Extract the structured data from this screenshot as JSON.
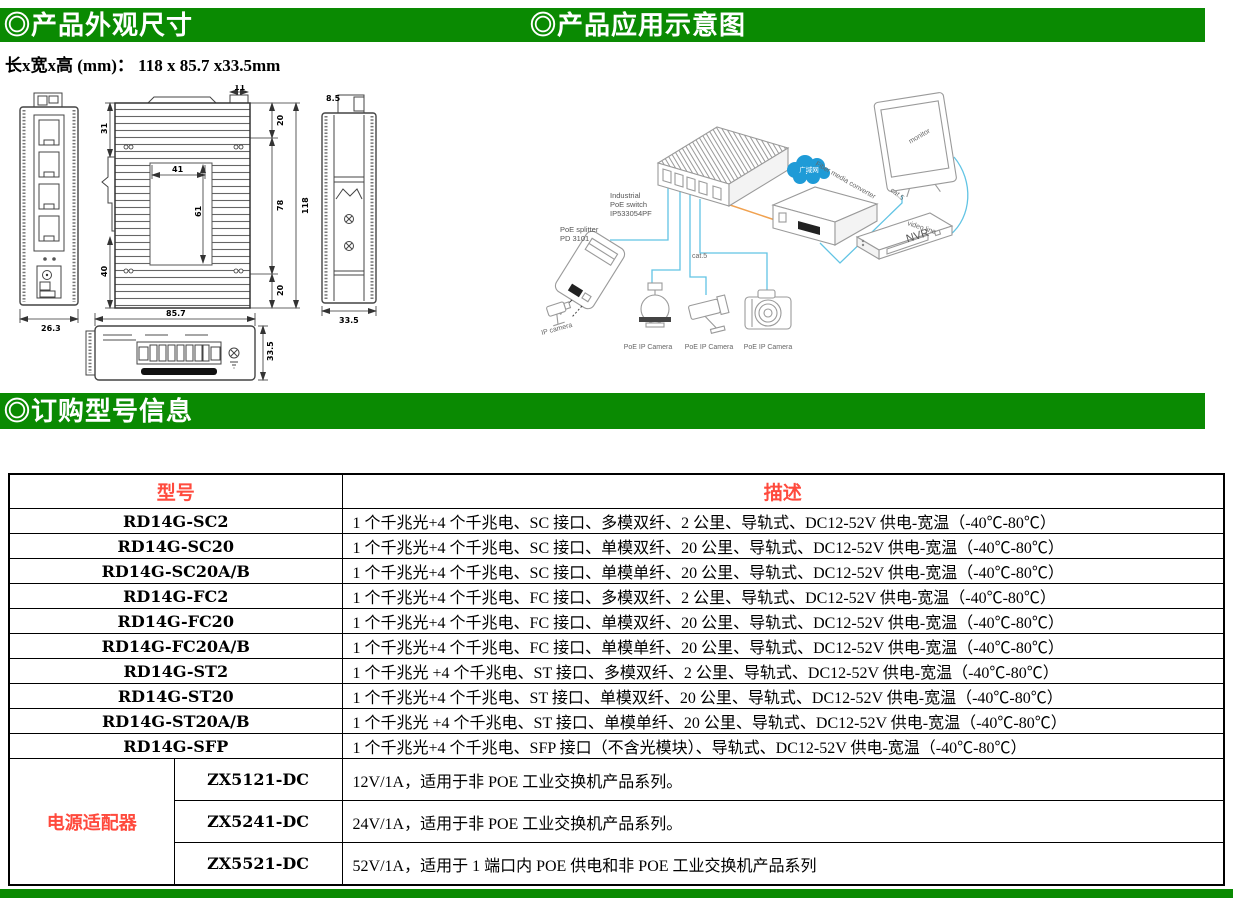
{
  "headers": {
    "dimensions_title": "◎产品外观尺寸",
    "application_title": "◎产品应用示意图",
    "ordering_title": "◎订购型号信息"
  },
  "size_label": "长x宽x高 (mm)： 118 x 85.7 x33.5mm",
  "colors": {
    "header_green": "#0a8a02",
    "table_header_red": "#ff4a3d",
    "cable_cyan": "#62c4e4",
    "cable_orange": "#f0a14f",
    "cloud_blue": "#1f9bd7"
  },
  "dims": {
    "front_width": "26.3",
    "main_top_tab": "11",
    "main_left_top": "31",
    "main_left_bottom": "40",
    "main_inner_width": "41",
    "main_inner_height": "61",
    "main_right_top": "20",
    "main_right_mid": "78",
    "main_right_bottom": "20",
    "main_total_height": "118",
    "bottom_width": "85.7",
    "bottom_height": "33.5",
    "side_top": "8.5",
    "side_bottom": "33.5"
  },
  "app": {
    "switch_label_1": "Industrial",
    "switch_label_2": "PoE switch",
    "switch_label_3": "IP533054PF",
    "splitter_label_1": "PoE splitter",
    "splitter_label_2": "PD 3101",
    "cloud_label": "广域网",
    "converter_label": "Fiber media converter",
    "monitor_label": "monitor",
    "nvr_label": "NVR",
    "cat5_center": "cat.5",
    "cat5_right": "cat.5",
    "video_line_label": "video line",
    "ip_camera_label": "IP camera",
    "poe_cam1": "PoE IP Camera",
    "poe_cam2": "PoE IP Camera",
    "poe_cam3": "PoE IP Camera"
  },
  "table": {
    "col_model": "型号",
    "col_desc": "描述",
    "rows": [
      {
        "model": "RD14G-SC2",
        "desc": "1 个千兆光+4 个千兆电、SC 接口、多模双纤、2 公里、导轨式、DC12-52V 供电-宽温（-40℃-80℃）"
      },
      {
        "model": "RD14G-SC20",
        "desc": "1 个千兆光+4 个千兆电、SC 接口、单模双纤、20 公里、导轨式、DC12-52V 供电-宽温（-40℃-80℃）"
      },
      {
        "model": "RD14G-SC20A/B",
        "desc": "1 个千兆光+4 个千兆电、SC 接口、单模单纤、20 公里、导轨式、DC12-52V 供电-宽温（-40℃-80℃）"
      },
      {
        "model": "RD14G-FC2",
        "desc": "1 个千兆光+4 个千兆电、FC 接口、多模双纤、2 公里、导轨式、DC12-52V 供电-宽温（-40℃-80℃）"
      },
      {
        "model": "RD14G-FC20",
        "desc": "1 个千兆光+4 个千兆电、FC 接口、单模双纤、20 公里、导轨式、DC12-52V 供电-宽温（-40℃-80℃）"
      },
      {
        "model": "RD14G-FC20A/B",
        "desc": "1 个千兆光+4 个千兆电、FC 接口、单模单纤、20 公里、导轨式、DC12-52V 供电-宽温（-40℃-80℃）"
      },
      {
        "model": "RD14G-ST2",
        "desc": "1 个千兆光 +4 个千兆电、ST 接口、多模双纤、2 公里、导轨式、DC12-52V 供电-宽温（-40℃-80℃）"
      },
      {
        "model": "RD14G-ST20",
        "desc": "1 个千兆光+4 个千兆电、ST 接口、单模双纤、20 公里、导轨式、DC12-52V 供电-宽温（-40℃-80℃）"
      },
      {
        "model": "RD14G-ST20A/B",
        "desc": "1 个千兆光 +4 个千兆电、ST 接口、单模单纤、20 公里、导轨式、DC12-52V 供电-宽温（-40℃-80℃）"
      },
      {
        "model": "RD14G-SFP",
        "desc": "1 个千兆光+4 个千兆电、SFP 接口（不含光模块）、导轨式、DC12-52V 供电-宽温（-40℃-80℃）"
      }
    ],
    "power_group": {
      "label": "电源适配器",
      "rows": [
        {
          "model": "ZX5121-DC",
          "desc": "12V/1A，适用于非 POE 工业交换机产品系列。"
        },
        {
          "model": "ZX5241-DC",
          "desc": "24V/1A，适用于非 POE 工业交换机产品系列。"
        },
        {
          "model": "ZX5521-DC",
          "desc": "52V/1A，适用于 1 端口内 POE 供电和非 POE 工业交换机产品系列"
        }
      ]
    }
  }
}
